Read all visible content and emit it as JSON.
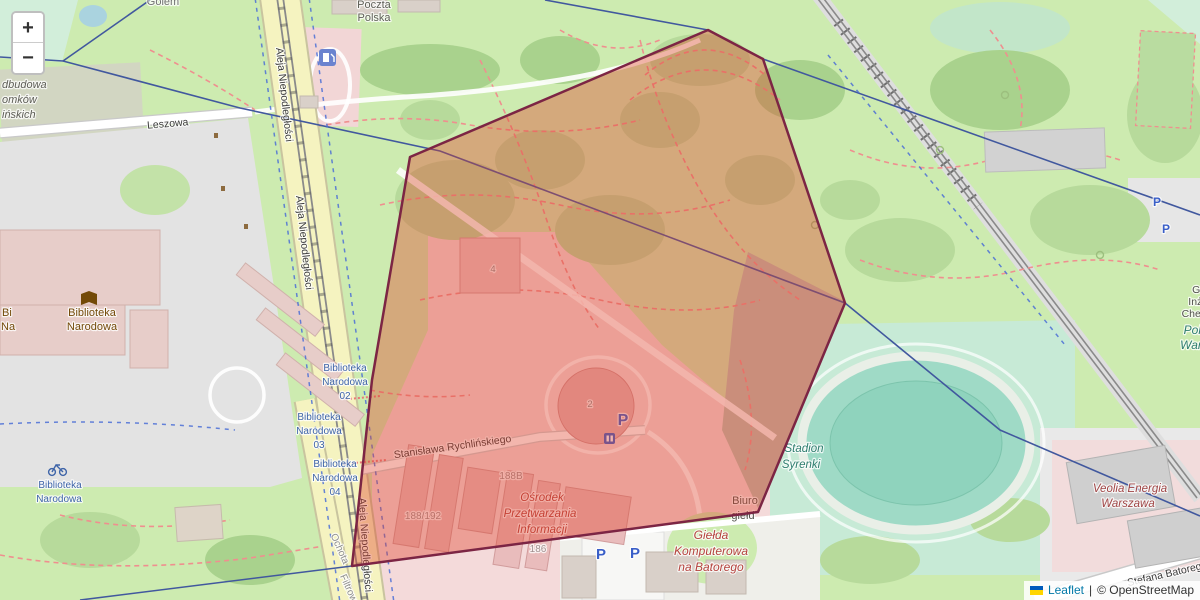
{
  "controls": {
    "zoom_in_label": "+",
    "zoom_out_label": "−"
  },
  "attribution": {
    "leaflet_link": "Leaflet",
    "separator": "|",
    "copyright_text": "© OpenStreetMap",
    "link_color": "#0078A8",
    "flag_top_color": "#005BBB",
    "flag_bottom_color": "#FFD500"
  },
  "overlay_polygon": {
    "stroke_color": "#7c2544",
    "fill_color": "rgba(224,62,40,0.38)",
    "points": [
      [
        708,
        30
      ],
      [
        763,
        59
      ],
      [
        845,
        303
      ],
      [
        758,
        512
      ],
      [
        352,
        566
      ],
      [
        372,
        380
      ],
      [
        410,
        157
      ]
    ]
  },
  "labels": [
    {
      "id": "golem",
      "text": "Golem",
      "x": 163,
      "y": 5,
      "size": 11,
      "color": "#6f6f6f"
    },
    {
      "id": "odbudowa-1",
      "text": "dbudowa",
      "x": 2,
      "y": 88,
      "size": 11,
      "color": "#5d5d55",
      "italic": true,
      "anchor": "start"
    },
    {
      "id": "odbudowa-2",
      "text": "omków",
      "x": 2,
      "y": 103,
      "size": 11,
      "color": "#5d5d55",
      "italic": true,
      "anchor": "start"
    },
    {
      "id": "odbudowa-3",
      "text": "ińskich",
      "x": 2,
      "y": 118,
      "size": 11,
      "color": "#5d5d55",
      "italic": true,
      "anchor": "start"
    },
    {
      "id": "leszowa",
      "text": "Leszowa",
      "x": 168,
      "y": 127,
      "size": 10.5,
      "color": "#3a3a3a",
      "rotate": -5
    },
    {
      "id": "aleja-niepodleglosci-1",
      "text": "Aleja Niepodległości",
      "x": 281,
      "y": 95,
      "size": 10.5,
      "color": "#3a3a3a",
      "rotate": 84
    },
    {
      "id": "aleja-niepodleglosci-2",
      "text": "Aleja Niepodległości",
      "x": 301,
      "y": 243,
      "size": 10.5,
      "color": "#3a3a3a",
      "rotate": 84
    },
    {
      "id": "aleja-niepodleglosci-3",
      "text": "Aleja Niepodległości",
      "x": 362,
      "y": 545,
      "size": 10.5,
      "color": "#3a3a3a",
      "rotate": 86
    },
    {
      "id": "ochota",
      "text": "Ochota",
      "x": 337,
      "y": 550,
      "size": 10,
      "color": "#8f8f8f",
      "rotate": 66
    },
    {
      "id": "filtrowa",
      "text": "Filtrowa",
      "x": 347,
      "y": 592,
      "size": 10,
      "color": "#8f8f8f",
      "rotate": 66
    },
    {
      "id": "poczta-polska-1",
      "text": "Poczta",
      "x": 374,
      "y": 8,
      "size": 11,
      "color": "#5e5e56"
    },
    {
      "id": "poczta-polska-2",
      "text": "Polska",
      "x": 374,
      "y": 21,
      "size": 11,
      "color": "#5e5e56"
    },
    {
      "id": "biblioteka-narodowa-1",
      "text": "Biblioteka",
      "x": 92,
      "y": 316,
      "size": 11,
      "color": "#734a08"
    },
    {
      "id": "biblioteka-narodowa-2",
      "text": "Narodowa",
      "x": 92,
      "y": 330,
      "size": 11,
      "color": "#734a08"
    },
    {
      "id": "biblioteka-clip-1",
      "text": "Bi",
      "x": 2,
      "y": 316,
      "size": 11,
      "color": "#734a08",
      "anchor": "start"
    },
    {
      "id": "biblioteka-clip-2",
      "text": "Na",
      "x": 1,
      "y": 330,
      "size": 11,
      "color": "#734a08",
      "anchor": "start"
    },
    {
      "id": "bus-stop-02-1",
      "text": "Biblioteka",
      "x": 345,
      "y": 371,
      "size": 10,
      "color": "#3e64a8"
    },
    {
      "id": "bus-stop-02-2",
      "text": "Narodowa",
      "x": 345,
      "y": 385,
      "size": 10,
      "color": "#3e64a8"
    },
    {
      "id": "bus-stop-02-3",
      "text": "02",
      "x": 345,
      "y": 399,
      "size": 10,
      "color": "#3e64a8"
    },
    {
      "id": "bus-stop-03-1",
      "text": "Biblioteka",
      "x": 319,
      "y": 420,
      "size": 10,
      "color": "#3e64a8"
    },
    {
      "id": "bus-stop-03-2",
      "text": "Narodowa",
      "x": 319,
      "y": 434,
      "size": 10,
      "color": "#3e64a8"
    },
    {
      "id": "bus-stop-03-3",
      "text": "03",
      "x": 319,
      "y": 448,
      "size": 10,
      "color": "#3e64a8"
    },
    {
      "id": "bus-stop-04-1",
      "text": "Biblioteka",
      "x": 335,
      "y": 467,
      "size": 10,
      "color": "#3e64a8"
    },
    {
      "id": "bus-stop-04-2",
      "text": "Narodowa",
      "x": 335,
      "y": 481,
      "size": 10,
      "color": "#3e64a8"
    },
    {
      "id": "bus-stop-04-3",
      "text": "04",
      "x": 335,
      "y": 495,
      "size": 10,
      "color": "#3e64a8"
    },
    {
      "id": "biblioteka-blue-1",
      "text": "Biblioteka",
      "x": 60,
      "y": 488,
      "size": 10,
      "color": "#3e64a8"
    },
    {
      "id": "biblioteka-blue-2",
      "text": "Narodowa",
      "x": 59,
      "y": 502,
      "size": 10,
      "color": "#3e64a8"
    },
    {
      "id": "rychlinskiego",
      "text": "Stanisława Rychlińskiego",
      "x": 453,
      "y": 450,
      "size": 10.5,
      "color": "#3a3a3a",
      "rotate": -8
    },
    {
      "id": "addr-188b",
      "text": "188B",
      "x": 511,
      "y": 479,
      "size": 10,
      "color": "#a18f8f"
    },
    {
      "id": "addr-188-192",
      "text": "188/192",
      "x": 423,
      "y": 519,
      "size": 10,
      "color": "#a18f8f"
    },
    {
      "id": "addr-186",
      "text": "186",
      "x": 538,
      "y": 552,
      "size": 10,
      "color": "#a18f8f"
    },
    {
      "id": "addr-4",
      "text": "4",
      "x": 493,
      "y": 272,
      "size": 9.5,
      "color": "#8d8d8d"
    },
    {
      "id": "addr-2",
      "text": "2",
      "x": 590,
      "y": 407,
      "size": 9.5,
      "color": "#8d8d8d"
    },
    {
      "id": "osrodek-1",
      "text": "Ośrodek",
      "x": 542,
      "y": 501,
      "size": 11.5,
      "color": "#b5433e",
      "italic": true
    },
    {
      "id": "osrodek-2",
      "text": "Przetwarzania",
      "x": 540,
      "y": 517,
      "size": 11.5,
      "color": "#b5433e",
      "italic": true
    },
    {
      "id": "osrodek-3",
      "text": "Informacji",
      "x": 542,
      "y": 533,
      "size": 11.5,
      "color": "#b5433e",
      "italic": true
    },
    {
      "id": "biuro-1",
      "text": "Biuro",
      "x": 745,
      "y": 504,
      "size": 11,
      "color": "#50504a"
    },
    {
      "id": "biuro-2",
      "text": "giełd",
      "x": 743,
      "y": 519,
      "size": 11,
      "color": "#50504a"
    },
    {
      "id": "gielda-1",
      "text": "Giełda",
      "x": 711,
      "y": 539,
      "size": 12,
      "color": "#b5433e",
      "italic": true
    },
    {
      "id": "gielda-2",
      "text": "Komputerowa",
      "x": 711,
      "y": 555,
      "size": 12,
      "color": "#b5433e",
      "italic": true
    },
    {
      "id": "gielda-3",
      "text": "na Batorego",
      "x": 711,
      "y": 571,
      "size": 12,
      "color": "#b5433e",
      "italic": true
    },
    {
      "id": "stadion-1",
      "text": "Stadion",
      "x": 804,
      "y": 452,
      "size": 11.5,
      "color": "#2e7d6e",
      "italic": true
    },
    {
      "id": "stadion-2",
      "text": "Syrenki",
      "x": 801,
      "y": 468,
      "size": 11.5,
      "color": "#2e7d6e",
      "italic": true
    },
    {
      "id": "gmach-1",
      "text": "Gmach",
      "x": 1209,
      "y": 293,
      "size": 10.5,
      "color": "#50504a"
    },
    {
      "id": "gmach-2",
      "text": "Inżynierii",
      "x": 1209,
      "y": 305,
      "size": 10.5,
      "color": "#50504a"
    },
    {
      "id": "gmach-3",
      "text": "Chemicznej",
      "x": 1209,
      "y": 317,
      "size": 10.5,
      "color": "#50504a"
    },
    {
      "id": "politechnika-1",
      "text": "Politechnika",
      "x": 1216,
      "y": 334,
      "size": 12,
      "color": "#2e7d6e",
      "italic": true
    },
    {
      "id": "politechnika-2",
      "text": "Warszawska",
      "x": 1214,
      "y": 349,
      "size": 12,
      "color": "#2e7d6e",
      "italic": true
    },
    {
      "id": "veolia-1",
      "text": "Veolia Energia",
      "x": 1130,
      "y": 492,
      "size": 11.5,
      "color": "#a04545",
      "italic": true
    },
    {
      "id": "veolia-2",
      "text": "Warszawa",
      "x": 1128,
      "y": 507,
      "size": 11.5,
      "color": "#a04545",
      "italic": true
    },
    {
      "id": "batorego",
      "text": "Stefana Batorego",
      "x": 1168,
      "y": 577,
      "size": 10.5,
      "color": "#3a3a3a",
      "rotate": -13
    },
    {
      "id": "parking-p-1",
      "text": "P",
      "x": 623,
      "y": 425,
      "size": 16,
      "color": "#3a5fc8",
      "bold": true
    },
    {
      "id": "parking-p-2",
      "text": "P",
      "x": 601,
      "y": 559,
      "size": 15,
      "color": "#3a5fc8",
      "bold": true
    },
    {
      "id": "parking-p-3",
      "text": "P",
      "x": 635,
      "y": 558,
      "size": 15,
      "color": "#3a5fc8",
      "bold": true
    },
    {
      "id": "parking-p-4",
      "text": "P",
      "x": 1157,
      "y": 206,
      "size": 12,
      "color": "#3a5fc8",
      "bold": true
    },
    {
      "id": "parking-p-5",
      "text": "P",
      "x": 1166,
      "y": 233,
      "size": 12,
      "color": "#3a5fc8",
      "bold": true
    }
  ]
}
